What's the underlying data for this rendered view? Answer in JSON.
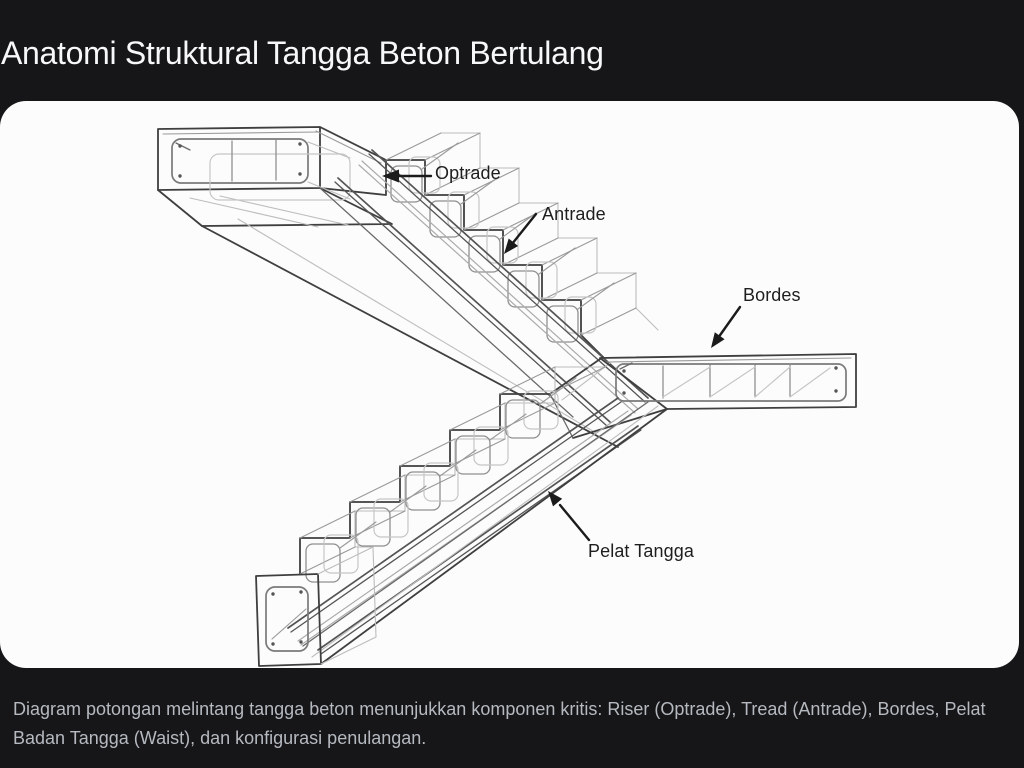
{
  "header": {
    "title": "Anatomi Struktural Tangga Beton Bertulang"
  },
  "diagram": {
    "kind": "wireframe line illustration of a reinforced concrete staircase: upper landing, upper flight, intermediate landing, lower flight, rebar stirrups",
    "labels": {
      "optrade": "Optrade",
      "antrade": "Antrade",
      "bordes": "Bordes",
      "pelat_tangga": "Pelat Tangga"
    }
  },
  "footer": {
    "caption": "Diagram potongan melintang tangga beton menunjukkan komponen kritis: Riser (Optrade), Tread (Antrade), Bordes, Pelat Badan Tangga (Waist), dan konfigurasi penulangan."
  },
  "colors": {
    "background": "#161618",
    "panel": "#fcfcfd",
    "line_art": "#3f3f3f",
    "label_text": "#1e1e1e",
    "title_text": "#f7f8f9",
    "caption_text": "#b5b9c0"
  }
}
